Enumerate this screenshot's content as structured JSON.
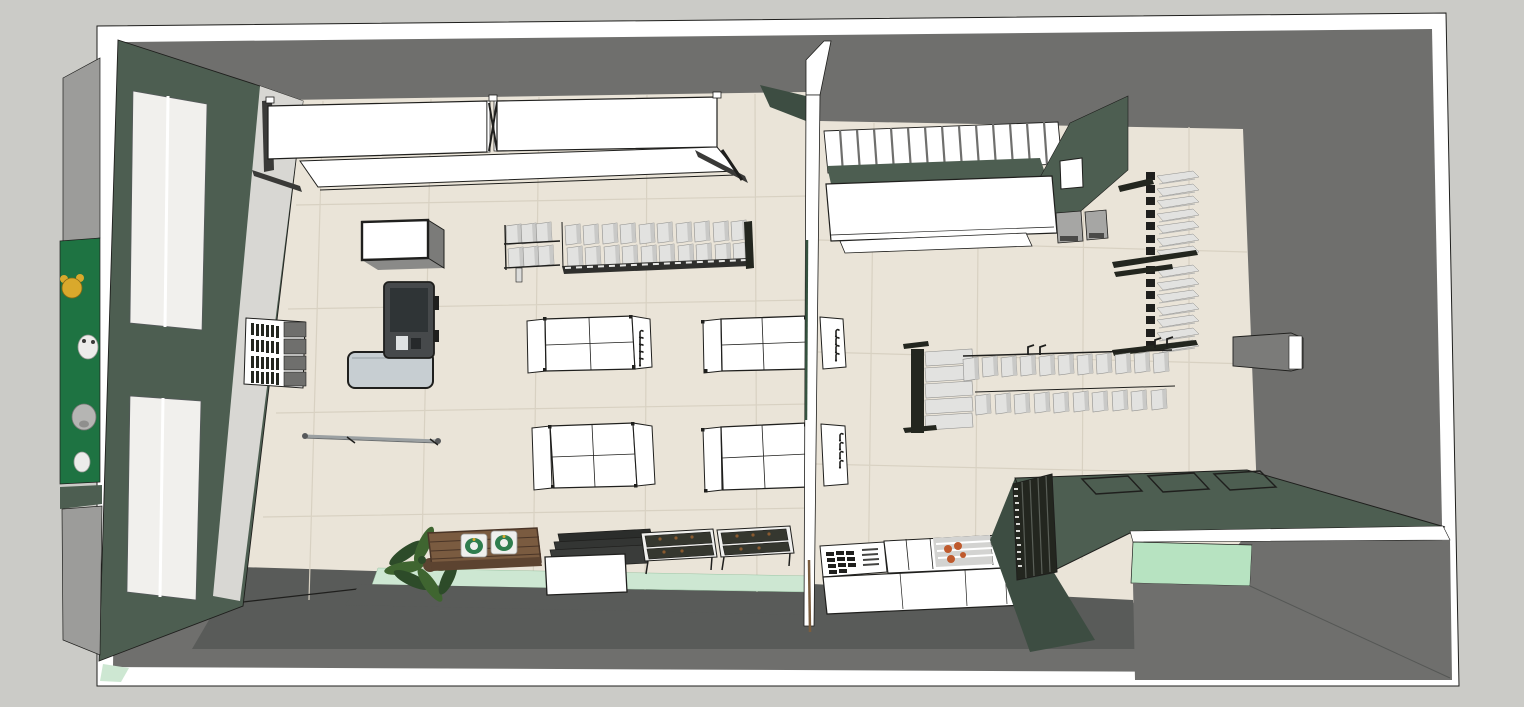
{
  "canvas": {
    "width": 1524,
    "height": 707
  },
  "colors": {
    "bg_outer": "#cbcbc7",
    "frame_white": "#ffffff",
    "ink": "#1f1f1d",
    "gray_wall": "#6f6f6d",
    "gray_dark": "#595b59",
    "gray_mid": "#9c9c9a",
    "floor_cream": "#eae4d8",
    "tile_line": "#d8d1c2",
    "green_main": "#4d5e51",
    "green_deep": "#3d4d42",
    "sign_green": "#1e7342",
    "mint": "#b7e3c1",
    "mint_floor": "#cde7d2",
    "glass": "#f1f0ed",
    "pier": "#d8d7d3",
    "counter_top": "#c7ced2",
    "register": "#46494b",
    "screen": "#2f3436",
    "product_light": "#e2e2e0",
    "product_mid": "#c9c9c7",
    "rack_black": "#23261f",
    "wood": "#7a5b40",
    "wood_dark": "#4a3527",
    "foliage": "#2d4b29",
    "foliage2": "#3f6530",
    "red_item": "#bf5a2d",
    "olive_item": "#31512f",
    "package_green": "#2f7d4e",
    "bear_yellow": "#d9a92c"
  },
  "scene_objects": [
    "building-shell",
    "exterior-wall-frame",
    "interior-wall-band",
    "sales-floor",
    "floor-tile-grid",
    "storefront-wall",
    "storefront-window",
    "entrance-pier",
    "wall-product-shelf",
    "mascot-signboard",
    "mascot-bear",
    "mascot-panda",
    "mascot-pig",
    "mascot-bunny",
    "ceiling-lightbox",
    "partition-glass-wall",
    "soffit-slat-panel",
    "wall-display-cabinet",
    "stool",
    "wall-shelf-column",
    "display-rack-vertical",
    "product-row",
    "gondola-shelf",
    "end-cap-hooks",
    "product-table",
    "wall-box-display",
    "checkout-counter",
    "cash-register",
    "clothing-rail",
    "window-display-platform",
    "plant",
    "wooden-bench",
    "product-sacks",
    "stacked-display-table",
    "tray-table",
    "produce-table",
    "slat-rack",
    "service-counter",
    "wall-mounted-box"
  ]
}
